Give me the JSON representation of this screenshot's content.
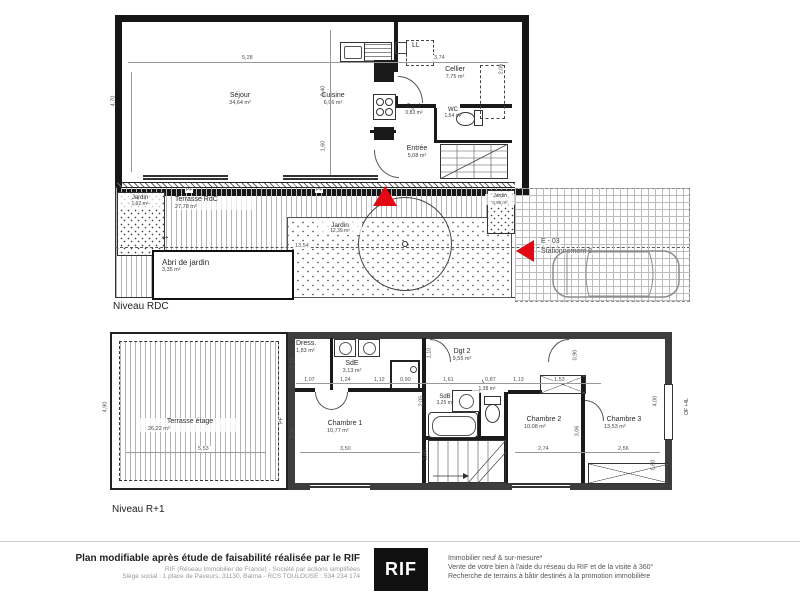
{
  "plan": {
    "rdc": {
      "level_label": "Niveau RDC",
      "rooms": [
        {
          "name": "Séjour",
          "area": "34,64 m²"
        },
        {
          "name": "Cuisine",
          "area": "6,96 m²"
        },
        {
          "name": "Cellier",
          "area": "7,75 m²"
        },
        {
          "name": "Dgt 1",
          "area": "0,83 m²"
        },
        {
          "name": "WC",
          "area": "1,54 m²"
        },
        {
          "name": "Entrée",
          "area": "5,08 m²"
        }
      ],
      "exterior": [
        {
          "name": "Terrasse RdC",
          "area": "27,78 m²"
        },
        {
          "name": "Jardin",
          "area": "1,92 m²"
        },
        {
          "name": "Jardin",
          "area": "12,39 m²"
        },
        {
          "name": "Jardin",
          "area": "0,95 m²"
        },
        {
          "name": "Abri de jardin",
          "area": "3,35 m²"
        }
      ],
      "parking": {
        "code": "E - 03",
        "label": "Stationnement 8"
      },
      "dims": [
        "5,28",
        "3,74",
        "4,70",
        "3,40",
        "1,60",
        "2,06",
        "13,54"
      ]
    },
    "r1": {
      "level_label": "Niveau R+1",
      "rooms": [
        {
          "name": "Terrasse étage",
          "area": "26,22 m²"
        },
        {
          "name": "Dress.",
          "area": "1,83 m²"
        },
        {
          "name": "SdE",
          "area": "3,13 m²"
        },
        {
          "name": "Dgt 2",
          "area": "9,55 m²"
        },
        {
          "name": "SdB",
          "area": "3,25 m²"
        },
        {
          "name": "WC",
          "area": "1,38 m²"
        },
        {
          "name": "Chambre 1",
          "area": "10,77 m²"
        },
        {
          "name": "Chambre 2",
          "area": "10,08 m²"
        },
        {
          "name": "Chambre 3",
          "area": "13,53 m²"
        }
      ],
      "dims": [
        "1,72",
        "1,07",
        "1,24",
        "1,12",
        "0,90",
        "1,61",
        "0,87",
        "1,13",
        "1,53",
        "1,10",
        "2,05",
        "0,90",
        "3,08",
        "3,50",
        "3,06",
        "2,74",
        "2,56",
        "4,00",
        "1,60",
        "0,60",
        "4,90",
        "5,53"
      ]
    },
    "annotations": {
      "pf": "PF",
      "ll": "LL",
      "of_4l": "OF +4L",
      "arrow": "↔"
    }
  },
  "footer": {
    "bold_line": "Plan modifiable après étude de faisabilité réalisée par le RIF",
    "sub_line1": "RIF (Réseau Immobilier de France) - Société par actions simplifiées",
    "sub_line2": "Siège social : 1 place de Paveurs, 31130, Balma - RCS TOULOUSE : 534 234 174",
    "logo": "RIF",
    "right_line1": "Immobilier neuf & sur-mesure*",
    "right_line2": "Vente de votre bien à l'aide du réseau du RIF et de la visite à 360°",
    "right_line3": "Recherche de terrains à bâtir destinés à la promotion immobilière"
  },
  "colors": {
    "accent_red": "#e30613",
    "wall_dark": "#1a1a1a",
    "wall_gray": "#3d3d3d"
  }
}
